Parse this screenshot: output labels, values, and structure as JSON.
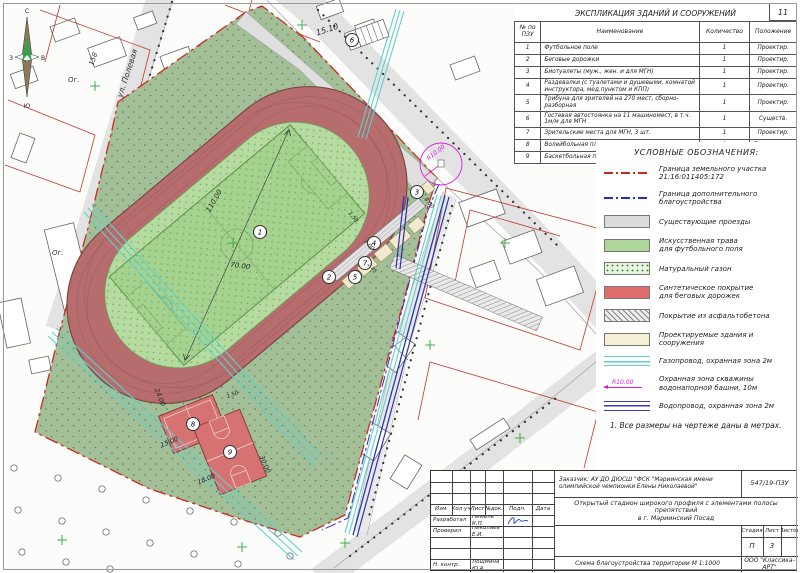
{
  "sheet": {
    "corner_mark": "11"
  },
  "colors": {
    "boundary_red": "#cc2a20",
    "boundary_blue": "#2a2ac0",
    "track": "#b76d6d",
    "field_grass": "#a5d28f",
    "lawn": "#a3bf97",
    "gas_pipe": "#5ed0cc",
    "water_pipe": "#2f2fae",
    "well_zone": "#d622d6",
    "court": "#d77272",
    "driveway": "#e3e3e3",
    "projected_building": "#f5efd5"
  },
  "explication": {
    "title": "ЭКСПЛИКАЦИЯ ЗДАНИЙ И СООРУЖЕНИЙ",
    "columns": [
      "№ по\nПЗУ",
      "Наименование",
      "Количество",
      "Положение"
    ],
    "rows": [
      [
        "1",
        "Футбольное поле",
        "1",
        "Проектир."
      ],
      [
        "2",
        "Беговые дорожки",
        "1",
        "Проектир."
      ],
      [
        "3",
        "Биотуалеты (муж., жен. и для МГН)",
        "1",
        "Проектир."
      ],
      [
        "4",
        "Раздевалки (с туалетами и душевыми, комнатой инструктора, мед.пунктом и КПП)",
        "1",
        "Проектир."
      ],
      [
        "5",
        "Трибуна для зрителей на 270 мест, сборно-разборная",
        "1",
        "Проектир."
      ],
      [
        "6",
        "Гостевая автостоянка на 11 машиномест, в т.ч. 1м/м для МГН",
        "1",
        "Существ."
      ],
      [
        "7",
        "Зрительские места для МГН, 3 шт.",
        "1",
        "Проектир."
      ],
      [
        "8",
        "Волейбольная площадка",
        "1",
        "Перспектива"
      ],
      [
        "9",
        "Баскетбольная площадка",
        "1",
        "Перспектива"
      ]
    ]
  },
  "legend": {
    "title": "УСЛОВНЫЕ ОБОЗНАЧЕНИЯ:",
    "items": [
      {
        "label": "Граница земельного участка\n21:16:011405:172"
      },
      {
        "label": "Граница дополнительного\nблагоустройства"
      },
      {
        "label": "Существующие проезды"
      },
      {
        "label": "Искусственная трава\nдля футбольного поля"
      },
      {
        "label": "Натуральный газон"
      },
      {
        "label": "Синтетическое покрытие\nдля беговых дорожек"
      },
      {
        "label": "Покрытие из асфальтобетона"
      },
      {
        "label": "Проектируемые здания и сооружения"
      },
      {
        "label": "Газопровод, охранная зона 2м"
      },
      {
        "label": "Охранная зона скважины\nводонапорной башни, 10м",
        "radius_label": "R10.00"
      },
      {
        "label": "Водопровод, охранная зона 2м"
      }
    ],
    "note": "1. Все размеры на чертеже даны в метрах."
  },
  "titleblock": {
    "customer": "Заказчик: АУ ДО ДЮСШ \"ФСК \"Мариинская имени олимпийской чемпионки Елены Николаевой\"",
    "doc_code": "547/19-ПЗУ",
    "project": "Открытый стадион широкого профиля с элементами полосы препятствий\nв г. Мариинский Посад",
    "change_cols": [
      "Изм.",
      "Кол.уч",
      "Лист",
      "№док.",
      "Подп.",
      "Дата"
    ],
    "roles": [
      {
        "role": "Разработал",
        "name": "Нимель К.П."
      },
      {
        "role": "Проверил",
        "name": "Николаев Е.И."
      },
      {
        "role": "Н. контр.",
        "name": "Лощмина Ю.А."
      }
    ],
    "stage_cols": [
      "Стадия",
      "Лист",
      "Листов"
    ],
    "stage": "П",
    "sheet_no": "3",
    "sheets_total": "",
    "scheme": "Схема благоустройства территории  М 1:1000",
    "company": "ООО \"Классика-АРТ\""
  },
  "plan": {
    "north": {
      "n": "С",
      "e": "В",
      "s": "Ю",
      "w": "З"
    },
    "streets": {
      "polevaya": "ул. Полевая",
      "nikolaeva": "ул. Николаева"
    },
    "markers": [
      "1",
      "2",
      "3",
      "4",
      "5",
      "6",
      "7",
      "8",
      "9"
    ],
    "dims": {
      "field_length": "110.00",
      "field_width": "70.00",
      "top_offset": "15.10",
      "court8_length": "24.00",
      "court8_width": "15.00",
      "court9_width": "18.00",
      "court9_length": "30.00",
      "gap": "1.50",
      "walk_150": "1.50",
      "walk_100": "1.00",
      "walk_800": "8.00",
      "walk_285": "2.85"
    },
    "radius_label": "R10.00",
    "parking_label": "Р",
    "labels": {
      "garden_1": "Ог.",
      "garden_2": "Ог.",
      "house_158": "158"
    }
  }
}
